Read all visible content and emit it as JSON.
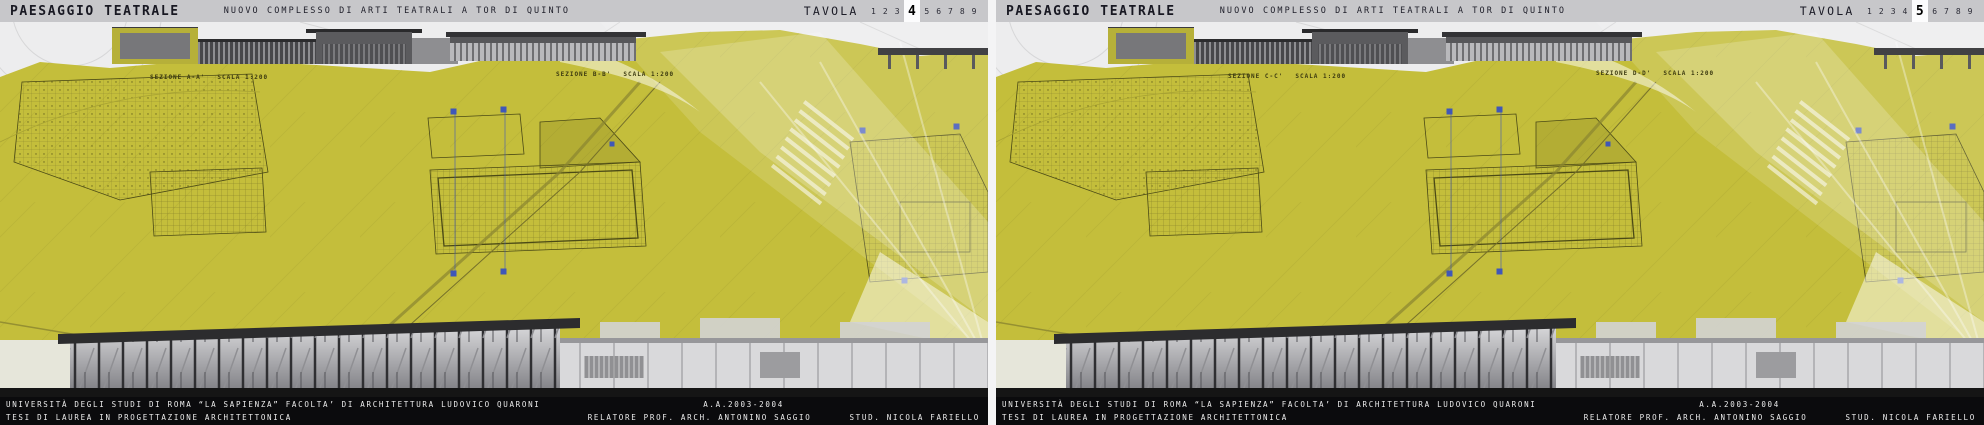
{
  "board": {
    "title": "PAESAGGIO TEATRALE",
    "subtitle": "NUOVO COMPLESSO DI ARTI TEATRALI A TOR DI QUINTO",
    "tavola_label": "TAVOLA",
    "tavola_numbers": [
      "1",
      "2",
      "3",
      "4",
      "5",
      "6",
      "7",
      "8",
      "9"
    ],
    "colors": {
      "field_yellow": "#c4be3b",
      "header_gray": "#c7c7ca",
      "footer_black": "#0b0b0d",
      "ink_dark": "#181822",
      "caption_olive": "#3c3a10",
      "marker_blue": "#3f57b8"
    }
  },
  "panels": [
    {
      "name": "tavola-4",
      "active_number": "4",
      "sections": [
        {
          "caption": "SEZIONE A-A'",
          "scale": "SCALA 1:200"
        },
        {
          "caption": "SEZIONE B-B'",
          "scale": "SCALA 1:200"
        }
      ]
    },
    {
      "name": "tavola-5",
      "active_number": "5",
      "sections": [
        {
          "caption": "SEZIONE C-C'",
          "scale": "SCALA 1:200"
        },
        {
          "caption": "SEZIONE D-D'",
          "scale": "SCALA 1:200"
        }
      ]
    }
  ],
  "footer": {
    "line1_left": "UNIVERSITÀ DEGLI STUDI DI ROMA “LA SAPIENZA”  FACOLTA’ DI ARCHITETTURA LUDOVICO QUARONI",
    "line1_right": "A.A.2003-2004",
    "line2_left": "TESI DI LAUREA IN PROGETTAZIONE ARCHITETTONICA",
    "line2_mid": "RELATORE PROF. ARCH. ANTONINO SAGGIO",
    "line2_right": "STUD. NICOLA FARIELLO"
  }
}
